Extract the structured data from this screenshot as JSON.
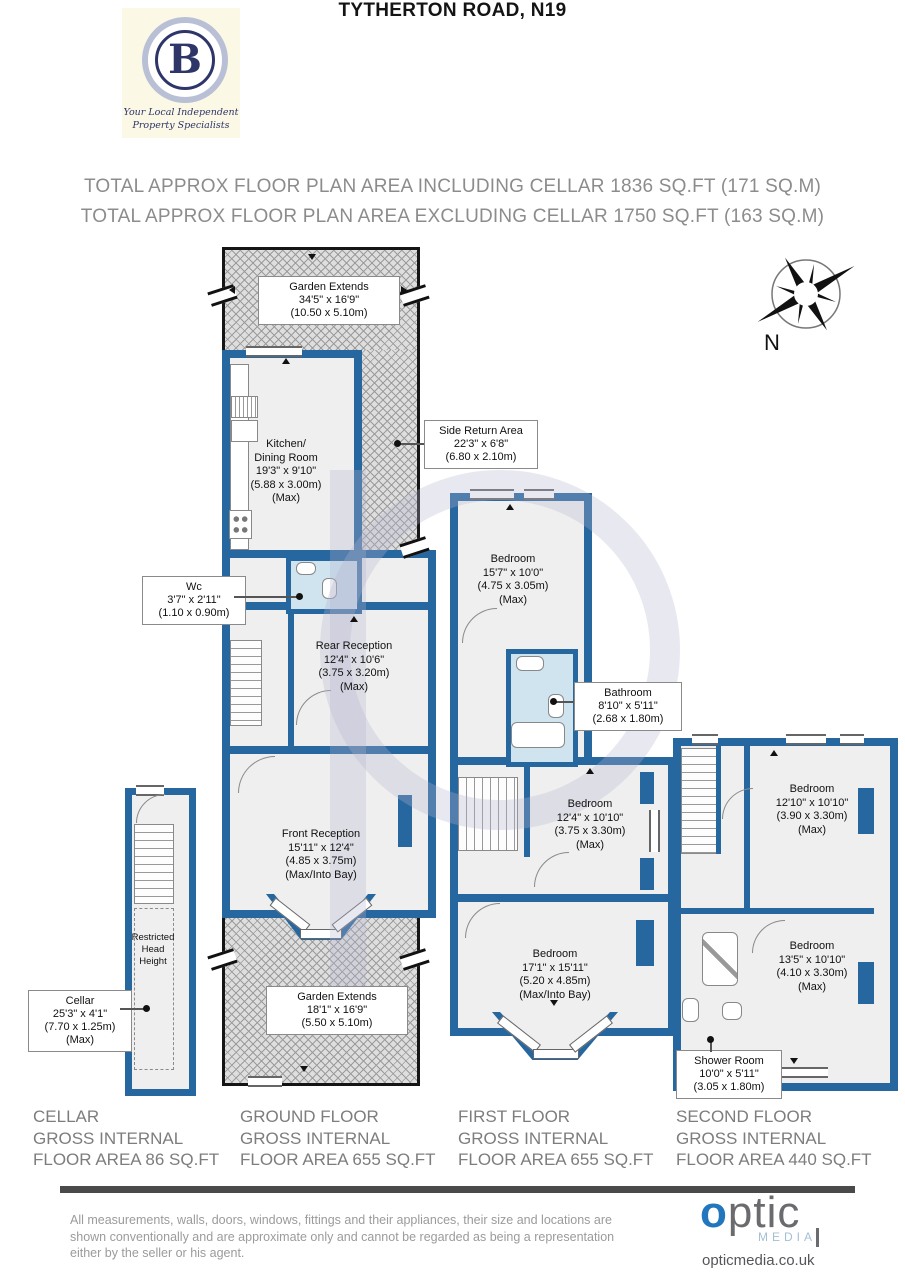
{
  "branding": {
    "logo_letter": "B",
    "tagline_line1": "Your Local Independent",
    "tagline_line2": "Property Specialists"
  },
  "header": {
    "title": "TYTHERTON ROAD, N19",
    "subtitle_including": "TOTAL APPROX FLOOR PLAN AREA INCLUDING CELLAR 1836 SQ.FT (171 SQ.M)",
    "subtitle_excluding": "TOTAL APPROX FLOOR PLAN AREA EXCLUDING CELLAR 1750 SQ.FT (163 SQ.M)"
  },
  "compass": {
    "label": "N"
  },
  "labels": {
    "garden_rear": {
      "lines": [
        "Garden Extends",
        "34'5\" x 16'9\"",
        "(10.50 x 5.10m)"
      ]
    },
    "kitchen": {
      "lines": [
        "Kitchen/",
        "Dining Room",
        "19'3\" x 9'10\"",
        "(5.88 x 3.00m)",
        "(Max)"
      ]
    },
    "side_return": {
      "lines": [
        "Side Return Area",
        "22'3\" x 6'8\"",
        "(6.80 x 2.10m)"
      ]
    },
    "wc": {
      "lines": [
        "Wc",
        "3'7\" x 2'11\"",
        "(1.10 x 0.90m)"
      ]
    },
    "rear_reception": {
      "lines": [
        "Rear Reception",
        "12'4\" x 10'6\"",
        "(3.75 x 3.20m)",
        "(Max)"
      ]
    },
    "front_reception": {
      "lines": [
        "Front Reception",
        "15'11\" x 12'4\"",
        "(4.85 x 3.75m)",
        "(Max/Into Bay)"
      ]
    },
    "garden_front": {
      "lines": [
        "Garden Extends",
        "18'1\" x 16'9\"",
        "(5.50 x 5.10m)"
      ]
    },
    "cellar": {
      "lines": [
        "Cellar",
        "25'3\" x 4'1\"",
        "(7.70 x 1.25m)",
        "(Max)"
      ]
    },
    "restricted": {
      "lines": [
        "Restricted",
        "Head",
        "Height"
      ]
    },
    "ff_bedroom_rear": {
      "lines": [
        "Bedroom",
        "15'7\" x 10'0\"",
        "(4.75 x 3.05m)",
        "(Max)"
      ]
    },
    "bathroom": {
      "lines": [
        "Bathroom",
        "8'10\" x 5'11\"",
        "(2.68 x 1.80m)"
      ]
    },
    "ff_bedroom_middle": {
      "lines": [
        "Bedroom",
        "12'4\" x 10'10\"",
        "(3.75 x 3.30m)",
        "(Max)"
      ]
    },
    "ff_bedroom_front": {
      "lines": [
        "Bedroom",
        "17'1\" x 15'11\"",
        "(5.20 x 4.85m)",
        "(Max/Into Bay)"
      ]
    },
    "sf_bedroom_rear": {
      "lines": [
        "Bedroom",
        "12'10\" x 10'10\"",
        "(3.90 x 3.30m)",
        "(Max)"
      ]
    },
    "sf_bedroom_front": {
      "lines": [
        "Bedroom",
        "13'5\" x 10'10\"",
        "(4.10 x 3.30m)",
        "(Max)"
      ]
    },
    "shower_room": {
      "lines": [
        "Shower Room",
        "10'0\" x 5'11\"",
        "(3.05 x 1.80m)"
      ]
    }
  },
  "floor_summaries": [
    {
      "lines": [
        "CELLAR",
        "GROSS INTERNAL",
        "FLOOR AREA 86 SQ.FT"
      ]
    },
    {
      "lines": [
        "GROUND FLOOR",
        "GROSS INTERNAL",
        "FLOOR AREA 655 SQ.FT"
      ]
    },
    {
      "lines": [
        "FIRST FLOOR",
        "GROSS INTERNAL",
        "FLOOR AREA 655 SQ.FT"
      ]
    },
    {
      "lines": [
        "SECOND FLOOR",
        "GROSS INTERNAL",
        "FLOOR AREA 440 SQ.FT"
      ]
    }
  ],
  "footer": {
    "disclaimer_lines": [
      "All measurements, walls, doors, windows, fittings and their appliances, their size and locations are",
      "shown conventionally and are approximate only and cannot be regarded as being a representation",
      "either by the seller or his agent."
    ],
    "optic_brand_o": "o",
    "optic_brand_rest": "ptic",
    "optic_media": "MEDIA",
    "optic_url": "opticmedia.co.uk"
  },
  "colors": {
    "wall_blue": "#2767a0",
    "bath_floor": "#cfe4ef",
    "optic_blue": "#2176bd"
  }
}
